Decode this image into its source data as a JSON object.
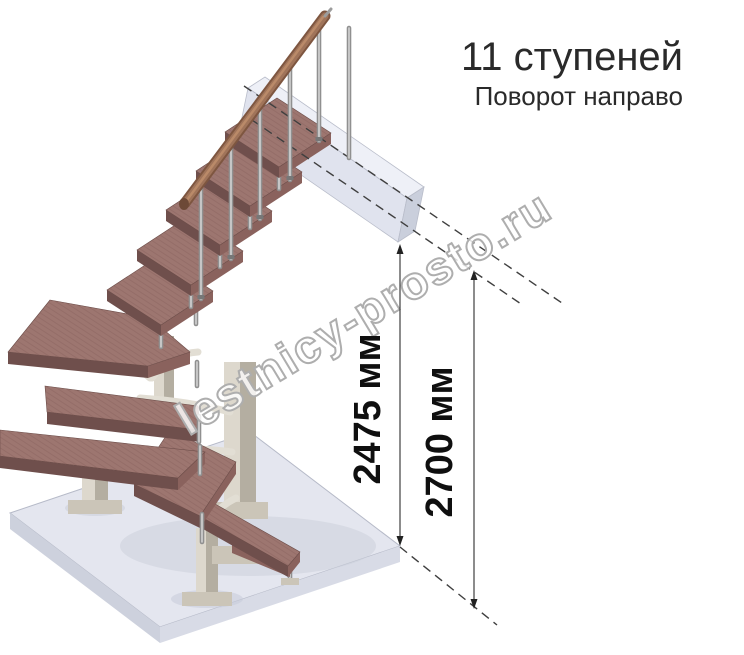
{
  "header": {
    "title": "11 ступеней",
    "subtitle": "Поворот направо"
  },
  "watermark": {
    "text": "lestnicy-prosto.ru"
  },
  "dimensions": {
    "stair_height": "2475 мм",
    "ceiling_height": "2700 мм"
  },
  "stair": {
    "steps_total": "11",
    "turn_direction": "направо"
  },
  "colors": {
    "tread_top": "#9d7670",
    "tread_dark": "#6f4f4c",
    "tread_mid": "#8a625d",
    "rail": "#a0745a",
    "rail_dark": "#7e5640",
    "beige": "#ddd8cd",
    "chrome": "#909090",
    "floor_top": "#e4e6ef",
    "slab_face": "#e0e3ee",
    "line": "#3f3f3f",
    "wm_stroke": "#aeaeae"
  }
}
